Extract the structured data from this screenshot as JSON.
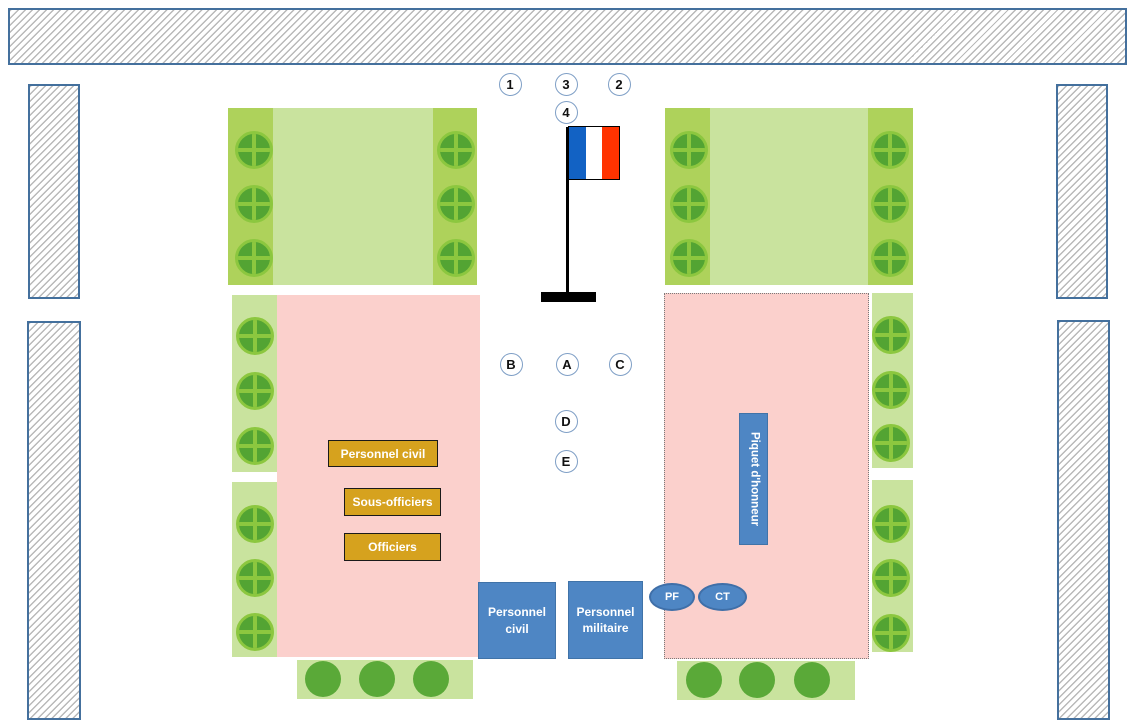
{
  "labels": {
    "personnel_civil_tribune": "Personnel civil",
    "sous_officiers_tribune": "Sous-officiers",
    "officiers_tribune": "Officiers",
    "personnel_civil_block": "Personnel civil",
    "personnel_militaire_block": "Personnel militaire",
    "piquet_honneur": "Piquet d'honneur",
    "pf_ellipse": "PF",
    "ct_ellipse": "CT"
  },
  "markers": {
    "items": [
      {
        "label": "1",
        "x": 510,
        "y": 84
      },
      {
        "label": "3",
        "x": 566,
        "y": 84
      },
      {
        "label": "2",
        "x": 619,
        "y": 84
      },
      {
        "label": "4",
        "x": 566,
        "y": 112
      },
      {
        "label": "B",
        "x": 511,
        "y": 364
      },
      {
        "label": "A",
        "x": 567,
        "y": 364
      },
      {
        "label": "C",
        "x": 620,
        "y": 364
      },
      {
        "label": "D",
        "x": 566,
        "y": 421
      },
      {
        "label": "E",
        "x": 566,
        "y": 461
      }
    ]
  },
  "trees": {
    "positions": [
      {
        "x": 254,
        "y": 150
      },
      {
        "x": 254,
        "y": 204
      },
      {
        "x": 254,
        "y": 258
      },
      {
        "x": 456,
        "y": 150
      },
      {
        "x": 456,
        "y": 204
      },
      {
        "x": 456,
        "y": 258
      },
      {
        "x": 689,
        "y": 150
      },
      {
        "x": 689,
        "y": 204
      },
      {
        "x": 689,
        "y": 258
      },
      {
        "x": 890,
        "y": 150
      },
      {
        "x": 890,
        "y": 204
      },
      {
        "x": 890,
        "y": 258
      },
      {
        "x": 255,
        "y": 336
      },
      {
        "x": 255,
        "y": 391
      },
      {
        "x": 255,
        "y": 446
      },
      {
        "x": 255,
        "y": 524
      },
      {
        "x": 255,
        "y": 578
      },
      {
        "x": 255,
        "y": 632
      },
      {
        "x": 891,
        "y": 335
      },
      {
        "x": 891,
        "y": 390
      },
      {
        "x": 891,
        "y": 443
      },
      {
        "x": 891,
        "y": 524
      },
      {
        "x": 891,
        "y": 578
      },
      {
        "x": 891,
        "y": 633
      }
    ]
  },
  "shrubs": {
    "positions": [
      {
        "x": 323,
        "y": 679
      },
      {
        "x": 377,
        "y": 679
      },
      {
        "x": 431,
        "y": 679
      },
      {
        "x": 704,
        "y": 680
      },
      {
        "x": 757,
        "y": 680
      },
      {
        "x": 812,
        "y": 680
      }
    ]
  },
  "colors": {
    "hatch_border": "#44709d",
    "hatch_line": "#b9b9b9",
    "green_light": "#c9e39e",
    "green_strip": "#aed25b",
    "tree_fill": "#53a433",
    "tree_ring": "#8cc73f",
    "shrub_fill": "#5aa938",
    "pink": "#fbd0cc",
    "pink_dotted_border": "#7a7a7a",
    "orange_fill": "#d6a21e",
    "orange_border": "#1a1a1a",
    "blue_fill": "#4e86c4",
    "blue_border": "#3f6fa8",
    "marker_border": "#7f9fc6",
    "flag_blue": "#1262c4",
    "flag_white": "#ffffff",
    "flag_red": "#ff3300",
    "pole_black": "#000000"
  }
}
